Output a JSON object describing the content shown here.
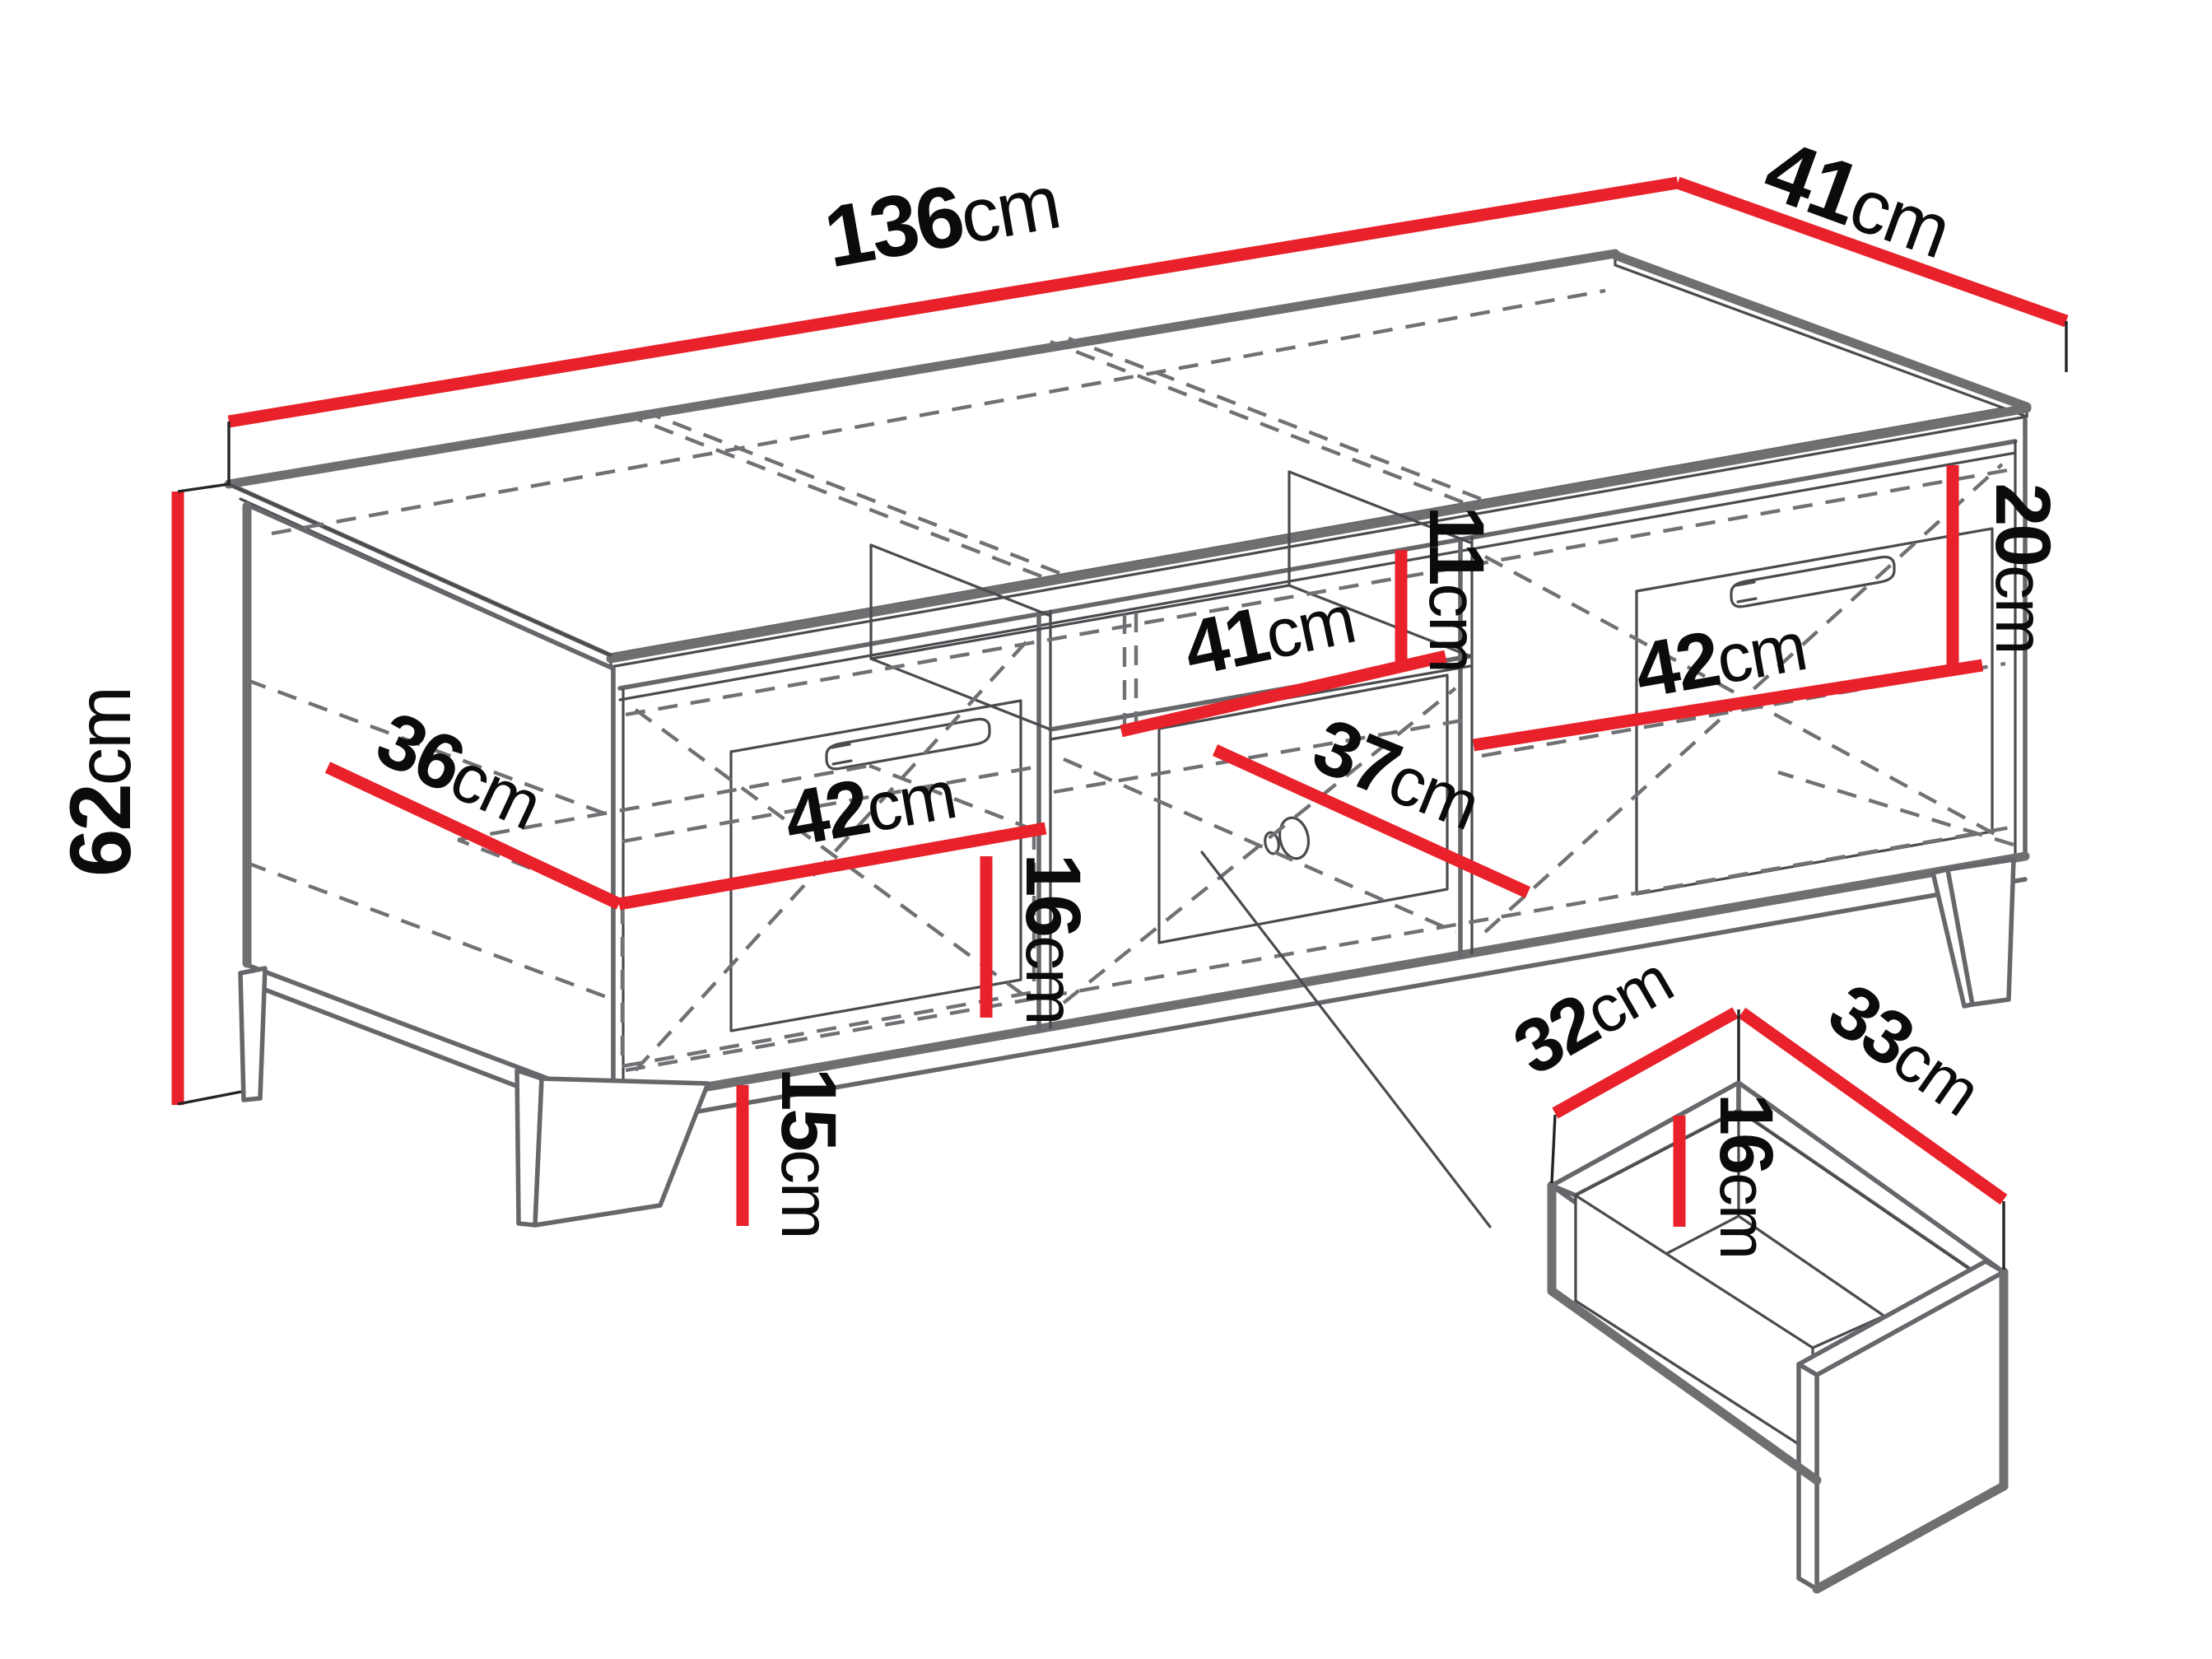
{
  "diagram": {
    "title": "tv-stand-dimension-drawing",
    "unit": "cm",
    "colors": {
      "dimension_red": "#e8212a",
      "outline_gray": "#66676a",
      "hidden_line_gray": "#707174",
      "text_black": "#0b0b0c",
      "background": "#ffffff"
    },
    "dims": {
      "top_width": {
        "value": "136",
        "unit": "cm"
      },
      "top_depth": {
        "value": "41",
        "unit": "cm"
      },
      "height": {
        "value": "62",
        "unit": "cm"
      },
      "left_depth": {
        "value": "36",
        "unit": "cm"
      },
      "left_drawer_width": {
        "value": "42",
        "unit": "cm"
      },
      "left_drawer_height": {
        "value": "16",
        "unit": "cm"
      },
      "niche_width": {
        "value": "41",
        "unit": "cm"
      },
      "niche_height": {
        "value": "11",
        "unit": "cm"
      },
      "middle_drawer_width": {
        "value": "37",
        "unit": "cm"
      },
      "right_door_width": {
        "value": "42",
        "unit": "cm"
      },
      "right_door_height": {
        "value": "20",
        "unit": "cm"
      },
      "leg_height": {
        "value": "15",
        "unit": "cm"
      },
      "drawer_box_depth": {
        "value": "32",
        "unit": "cm"
      },
      "drawer_box_width": {
        "value": "33",
        "unit": "cm"
      },
      "drawer_box_height": {
        "value": "16",
        "unit": "cm"
      }
    }
  }
}
